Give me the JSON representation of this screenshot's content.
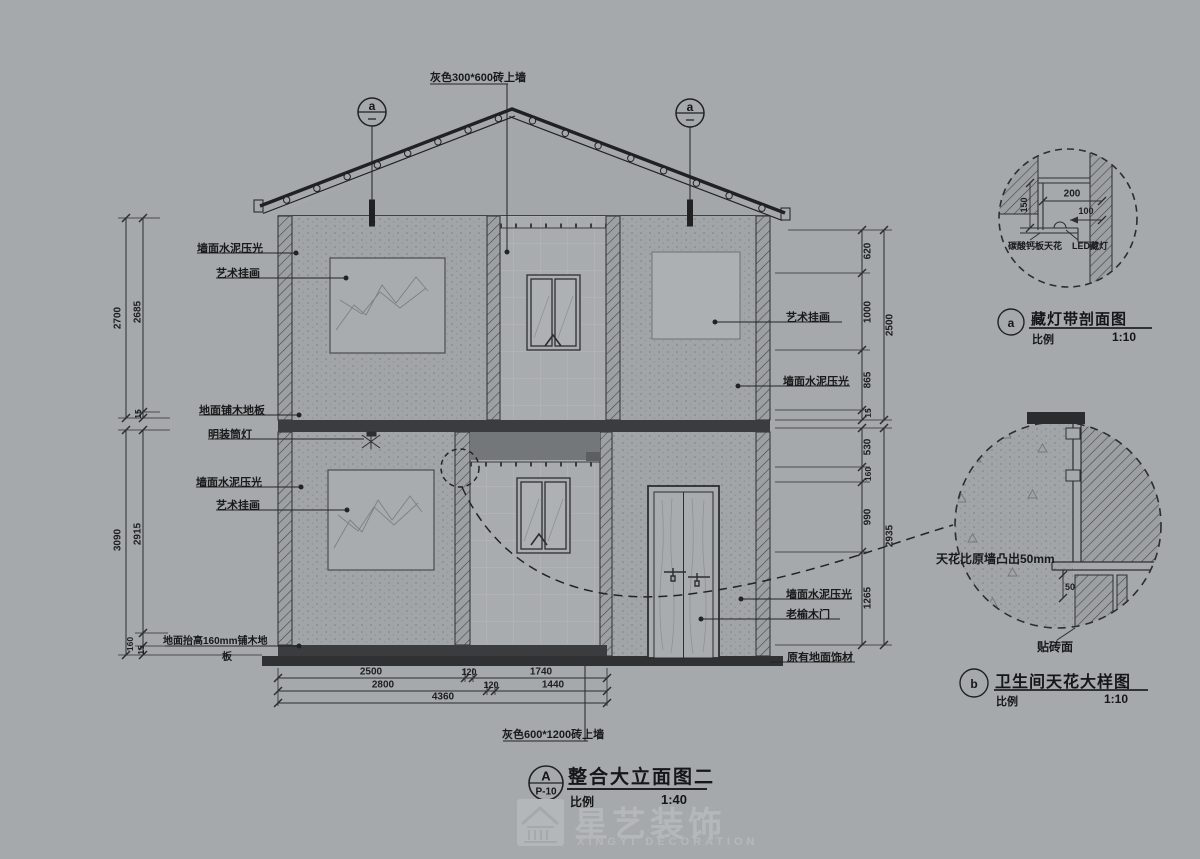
{
  "sheet": {
    "title_marker": "A",
    "sheet_no": "P-10",
    "title": "整合大立面图二",
    "scale_label": "比例",
    "scale_value": "1:40"
  },
  "elevation": {
    "top_note": "灰色300*600砖上墙",
    "bottom_note": "灰色600*1200砖上墙",
    "marker_a": "a",
    "labels": {
      "wall_cement_2f_left": "墙面水泥压光",
      "art_2f_left": "艺术挂画",
      "wood_floor": "地面铺木地板",
      "downlight": "明装筒灯",
      "wall_cement_1f_left": "墙面水泥压光",
      "art_1f_left": "艺术挂画",
      "raised_floor_line1": "地面抬高160mm铺木地",
      "raised_floor_line2": "板",
      "art_2f_right": "艺术挂画",
      "wall_cement_2f_right": "墙面水泥压光",
      "wall_cement_1f_right": "墙面水泥压光",
      "elm_door": "老榆木门",
      "original_floor": "原有地面饰材"
    },
    "dims": {
      "left_upper_total": "2700",
      "left_upper_main": "2685",
      "left_upper_gap": "15",
      "left_lower_total": "3090",
      "left_lower_main": "2915",
      "left_lower_raise": "160",
      "left_lower_gap": "15",
      "right_upper_d1": "620",
      "right_upper_d2": "1000",
      "right_upper_d3": "865",
      "right_upper_d4": "15",
      "right_upper_total": "2500",
      "right_lower_d1": "530",
      "right_lower_d2": "160",
      "right_lower_d3": "990",
      "right_lower_d4": "1265",
      "right_lower_total": "2935",
      "bottom_r1a": "2500",
      "bottom_r1b": "120",
      "bottom_r1c": "1740",
      "bottom_r2a": "2800",
      "bottom_r2b": "120",
      "bottom_r2c": "1440",
      "bottom_r3": "4360"
    }
  },
  "detail_a": {
    "marker": "a",
    "title": "藏灯带剖面图",
    "scale_label": "比例",
    "scale_value": "1:10",
    "dim_width": "200",
    "dim_depth": "100",
    "dim_height": "150",
    "note_board": "碳酸钙板天花",
    "note_led": "LED藏灯"
  },
  "detail_b": {
    "marker": "b",
    "title": "卫生间天花大样图",
    "scale_label": "比例",
    "scale_value": "1:10",
    "note_ceiling": "天花比原墙凸出50mm",
    "dim_step": "50",
    "note_tile": "贴砖面"
  },
  "watermark": {
    "brand": "星艺装饰",
    "sub": "XINGYI DECORATION"
  }
}
